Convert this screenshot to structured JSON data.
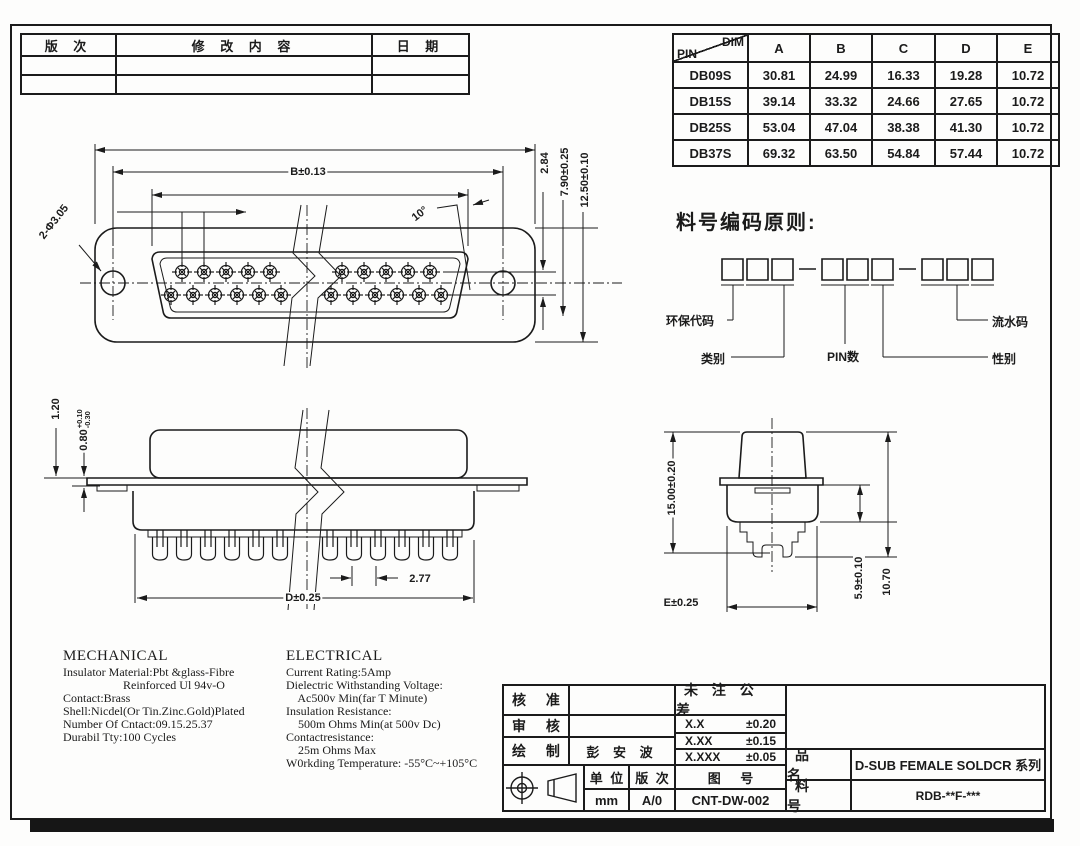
{
  "revision_table": {
    "col_version": "版 次",
    "col_content": "修 改 内 容",
    "col_date": "日 期"
  },
  "dim_table": {
    "corner_dim": "DIM",
    "corner_pin": "PIN",
    "columns": [
      "A",
      "B",
      "C",
      "D",
      "E"
    ],
    "rows": [
      {
        "pin": "DB09S",
        "values": [
          "30.81",
          "24.99",
          "16.33",
          "19.28",
          "10.72"
        ]
      },
      {
        "pin": "DB15S",
        "values": [
          "39.14",
          "33.32",
          "24.66",
          "27.65",
          "10.72"
        ]
      },
      {
        "pin": "DB25S",
        "values": [
          "53.04",
          "47.04",
          "38.38",
          "41.30",
          "10.72"
        ]
      },
      {
        "pin": "DB37S",
        "values": [
          "69.32",
          "63.50",
          "54.84",
          "57.44",
          "10.72"
        ]
      }
    ]
  },
  "coding": {
    "title": "料号编码原则:",
    "labels": {
      "eco": "环保代码",
      "category": "类别",
      "pin_count": "PIN数",
      "serial": "流水码",
      "gender": "性别"
    }
  },
  "dims": {
    "front": {
      "b": "B±0.13",
      "holes": "2-Φ3.05",
      "angle": "10°",
      "row_pitch": "2.84",
      "h7": "7.90±0.25",
      "h12": "12.50±0.10"
    },
    "side": {
      "t1": "1.20",
      "t2": "0.80",
      "t2_plus": "+0.10",
      "t2_minus": "-0.30",
      "d": "D±0.25",
      "pitch": "2.77"
    },
    "end": {
      "h15": "15.00±0.20",
      "e": "E±0.25",
      "h59": "5.9±0.10",
      "h107": "10.70"
    }
  },
  "mechanical": {
    "title": "MECHANICAL",
    "lines": [
      "Insulator Material:Pbt &glass-Fibre",
      "                    Reinforced Ul 94v-O",
      "Contact:Brass",
      "Shell:Nicdel(Or Tin.Zinc.Gold)Plated",
      "Number Of Cntact:09.15.25.37",
      "Durabil Tty:100 Cycles"
    ]
  },
  "electrical": {
    "title": "ELECTRICAL",
    "lines": [
      "Current Rating:5Amp",
      "Dielectric Withstanding Voltage:",
      "    Ac500v Min(far T Minute)",
      "Insulation Resistance:",
      "    500m Ohms Min(at 500v Dc)",
      "Contactresistance:",
      "    25m Ohms Max",
      "W0rkding Temperature: -55°C~+105°C"
    ]
  },
  "title_block": {
    "approved_label": "核 准",
    "reviewed_label": "审 核",
    "drawn_label": "绘 制",
    "drawn_by": "彭 安 波",
    "tolerance_title": "未 注 公 差",
    "tolerances": [
      {
        "digits": "X.X",
        "tol": "±0.20"
      },
      {
        "digits": "X.XX",
        "tol": "±0.15"
      },
      {
        "digits": "X.XXX",
        "tol": "±0.05"
      }
    ],
    "unit_label": "单 位",
    "unit_value": "mm",
    "rev_label": "版 次",
    "rev_value": "A/0",
    "drawing_no_label": "图  号",
    "drawing_no_value": "CNT-DW-002",
    "product_label": "品 名",
    "product_value": "D-SUB FEMALE SOLDCR 系列",
    "part_no_label": "料 号",
    "part_no_value": "RDB-**F-***"
  }
}
